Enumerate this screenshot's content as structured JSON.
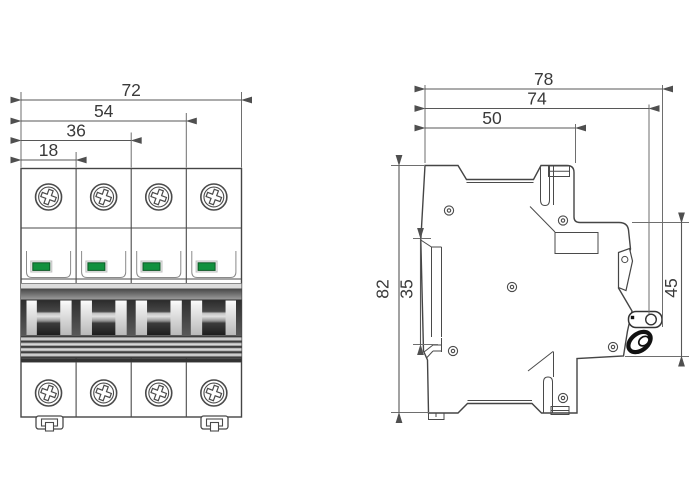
{
  "front_view": {
    "dim_total_width": "72",
    "dim_three_pole": "54",
    "dim_two_pole": "36",
    "dim_one_pole": "18",
    "pole_count": 4
  },
  "side_view": {
    "dim_overall_depth": "78",
    "dim_depth_with_handle": "74",
    "dim_body_depth": "50",
    "dim_overall_height": "82",
    "dim_din_slot_height": "35",
    "dim_front_face_height": "45"
  },
  "colors": {
    "indicator_green": "#12913e",
    "outline": "#454545",
    "dim_text": "#3a3a3a"
  }
}
